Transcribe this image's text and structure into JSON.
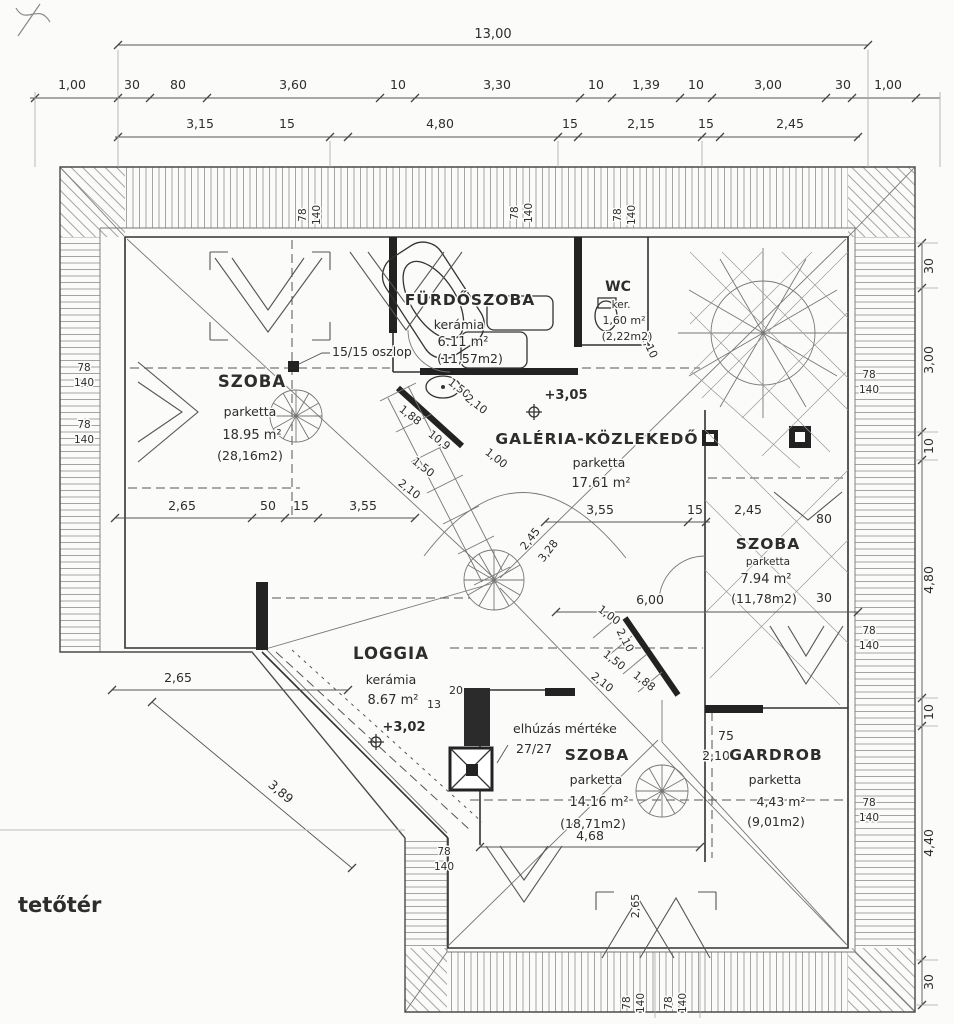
{
  "drawing_title": "tetőtér",
  "rooms": [
    {
      "name": "SZOBA",
      "finish": "parketta",
      "area": "18.95 m²",
      "gross": "(28,16m2)"
    },
    {
      "name": "FÜRDŐSZOBA",
      "finish": "kerámia",
      "area": "6.11 m²",
      "gross": "(11,57m2)"
    },
    {
      "name": "WC",
      "finish": "ker.",
      "area": "1,60 m²",
      "gross": "(2,22m2)"
    },
    {
      "name": "GALÉRIA-KÖZLEKEDŐ",
      "finish": "parketta",
      "area": "17.61 m²",
      "gross": ""
    },
    {
      "name": "SZOBA",
      "finish": "parketta",
      "area": "7.94 m²",
      "gross": "(11,78m2)"
    },
    {
      "name": "LOGGIA",
      "finish": "kerámia",
      "area": "8.67 m²",
      "gross": ""
    },
    {
      "name": "SZOBA",
      "finish": "parketta",
      "area": "14.16 m²",
      "gross": "(18,71m2)"
    },
    {
      "name": "GARDROB",
      "finish": "parketta",
      "area": "4,43 m²",
      "gross": "(9,01m2)"
    }
  ],
  "levels": {
    "gallery": "+3,05",
    "loggia": "+3,02"
  },
  "notes": {
    "column": "15/15 oszlop",
    "offset_label": "elhúzás mértéke",
    "offset_value": "27/27",
    "stair_riser": "20",
    "stair_tread": "13",
    "stair_width": "10,9"
  },
  "window_mark": {
    "w": "78",
    "h": "140"
  },
  "dims": {
    "overall": "13,00",
    "row2": [
      "1,00",
      "30",
      "80",
      "3,60",
      "10",
      "3,30",
      "10",
      "1,39",
      "10",
      "3,00",
      "30",
      "1,00"
    ],
    "row3": [
      "3,15",
      "15",
      "4,80",
      "15",
      "2,15",
      "15",
      "2,45"
    ],
    "right": [
      "30",
      "3,00",
      "10",
      "4,80",
      "10",
      "4,40",
      "30"
    ],
    "left_mid": [
      "2,65",
      "50",
      "15",
      "3,55"
    ],
    "center_mid": [
      "3,55",
      "15"
    ],
    "lower_left": [
      "2,65",
      "3,89"
    ],
    "bottom": "4,68",
    "right_mid": [
      "6,00",
      "30",
      "80",
      "2,45"
    ],
    "gardrob": [
      "75",
      "2,10"
    ],
    "diag": [
      "1,88",
      "1,50",
      "2,10",
      "1,50",
      "2,10",
      "1,00",
      "2,45",
      "3,28",
      "1,00",
      "2,10",
      "1,50",
      "2,10",
      "1,88",
      "2,10",
      "2,65"
    ]
  }
}
